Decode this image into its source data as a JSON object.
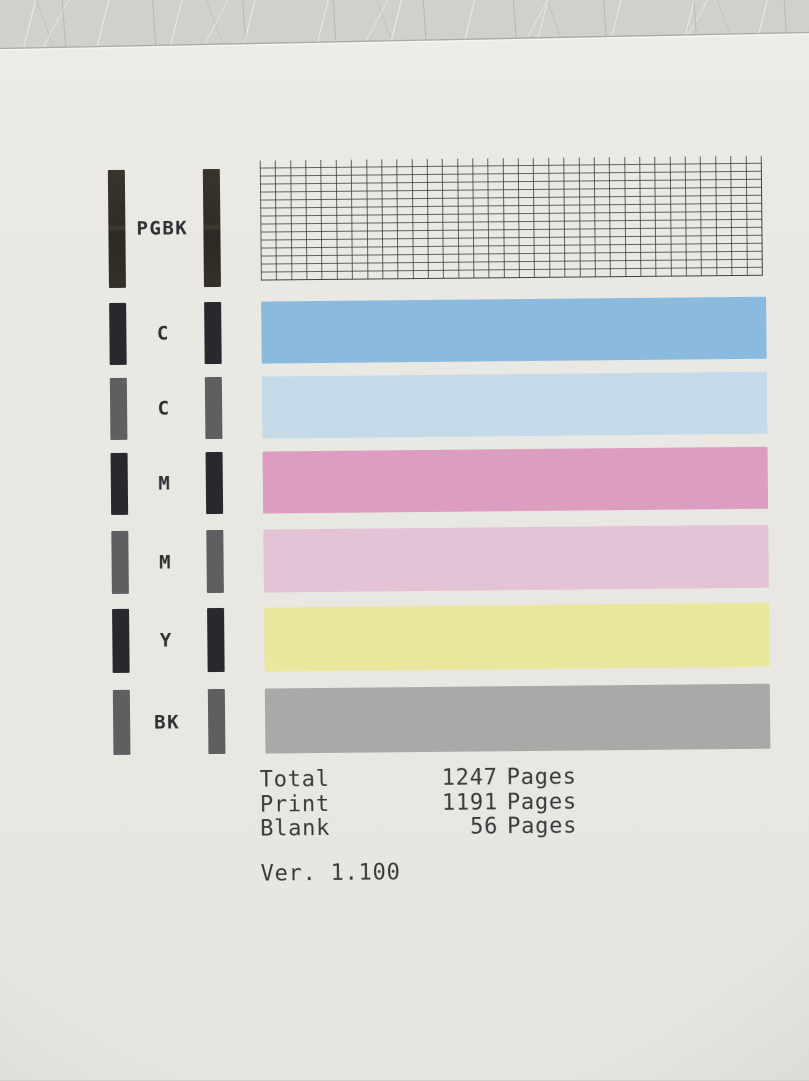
{
  "rows": [
    {
      "label": "PGBK",
      "marker_style": "dark",
      "pattern": "grid",
      "grid": {
        "cols": 33,
        "rows": 14,
        "line_color": "rgba(58,58,58,0.78)"
      }
    },
    {
      "label": "C",
      "marker_style": "dark",
      "color": "#8abadd"
    },
    {
      "label": "C",
      "marker_style": "gray",
      "color": "#c5dae8"
    },
    {
      "label": "M",
      "marker_style": "dark",
      "color": "#dc9dc0"
    },
    {
      "label": "M",
      "marker_style": "gray",
      "color": "#e5c3d7"
    },
    {
      "label": "Y",
      "marker_style": "dark",
      "color": "#ebe69d"
    },
    {
      "label": "BK",
      "marker_style": "gray",
      "color": "#a9aaa8"
    }
  ],
  "stats": {
    "rows": [
      {
        "label": "Total",
        "value": "1247",
        "unit": "Pages"
      },
      {
        "label": "Print",
        "value": "1191",
        "unit": "Pages"
      },
      {
        "label": "Blank",
        "value": "56",
        "unit": "Pages"
      }
    ],
    "version": "Ver. 1.100"
  },
  "colors": {
    "paper": "#e9e8e3",
    "table_surface": "#d2d0cb",
    "dark_marker": "#28292d",
    "gray_marker": "#5e5f61",
    "text": "#3a3a3c"
  }
}
